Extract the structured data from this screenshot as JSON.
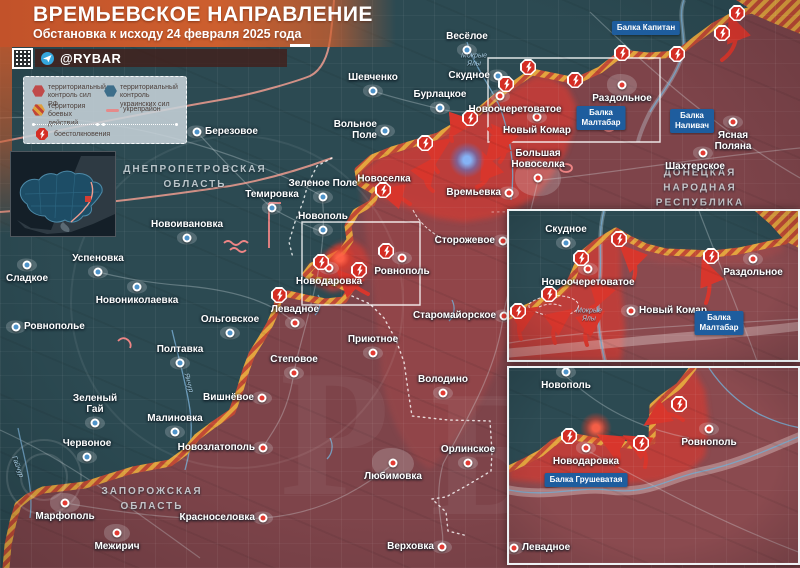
{
  "header": {
    "title": "ВРЕМЬЕВСКОЕ НАПРАВЛЕНИЕ",
    "subtitle": "Обстановка к исходу 24 февраля 2025 года",
    "channel": "@RYBAR"
  },
  "legend": {
    "items": [
      {
        "id": "rf",
        "label": "территориальный контроль сил РФ"
      },
      {
        "id": "ua",
        "label": "территориальный контроль украинских сил"
      },
      {
        "id": "battle",
        "label": "территория боевых действий"
      },
      {
        "id": "fort",
        "label": "укрепрайон"
      },
      {
        "id": "clash",
        "label": "боестолкновения"
      }
    ]
  },
  "colors": {
    "rf_area": "#7e444a",
    "ua_area": "#2c4a52",
    "advance": "#c53c38",
    "front_hatch_orange": "#e3a43e",
    "front_hatch_red": "#c14a35",
    "arrow": "#d8362c",
    "balka_box": "#1e5d9e",
    "banner": "#cd5f2e"
  },
  "map": {
    "size": [
      800,
      568
    ],
    "shapes": [
      {
        "c": "rf",
        "d": "M 800,30 L 775,20 L 752,10 L 736,14 L 714,26 L 695,40 L 677,54 L 648,56 L 622,53 L 600,70 L 576,81 L 552,76 L 532,72 L 512,86 L 496,97 L 478,112 L 460,123 L 438,136 L 412,144 L 392,150 L 372,158 L 358,170 L 360,183 L 376,192 L 372,203 L 356,212 L 348,226 L 350,240 L 342,252 L 326,260 L 312,266 L 306,274 L 316,280 L 336,283 L 350,290 L 344,300 L 326,302 L 306,298 L 288,294 L 279,296 L 276,310 L 270,324 L 262,338 L 252,354 L 246,370 L 240,390 L 232,412 L 213,425 L 197,437 L 185,452 L 170,463 L 133,470 L 110,477 L 85,485 L 60,488 L 43,490 L 28,497 L 18,505 L 13,522 L 8,545 L 6,568 L 800,568 Z"
      },
      {
        "c": "mid",
        "d": "M 360,180 C 420,200 470,215 520,210 C 540,250 520,320 500,360 C 480,410 450,450 430,470 C 400,450 380,400 380,350 C 375,300 365,240 360,180 Z"
      },
      {
        "c": "bright",
        "d": "M 360,172 L 380,156 L 410,146 L 438,138 L 462,125 L 482,113 L 500,98 L 515,88 L 535,76 L 552,78 L 568,88 L 576,105 L 574,128 L 566,152 L 552,176 L 536,196 L 514,210 L 490,218 L 464,222 L 436,218 L 408,208 L 384,198 L 366,188 Z"
      },
      {
        "c": "bright",
        "d": "M 306,270 L 322,256 L 338,244 L 352,240 L 364,248 L 370,262 L 366,276 L 352,287 L 332,292 L 314,284 Z"
      },
      {
        "c": "road",
        "d": "M 590,12 C 650,70 720,132 800,178"
      },
      {
        "c": "road",
        "d": "M 0,118 C 110,112 240,150 322,196"
      },
      {
        "c": "road",
        "d": "M 322,196 C 330,260 302,330 294,372 C 287,420 268,436 263,448"
      },
      {
        "c": "road",
        "d": "M 538,180 C 522,250 507,290 503,318 C 496,372 466,420 443,464 C 432,505 446,530 442,546"
      },
      {
        "c": "road",
        "d": "M 540,180 C 600,175 680,160 800,148"
      },
      {
        "c": "road",
        "d": "M 0,430 C 70,462 122,502 200,558"
      },
      {
        "c": "road",
        "d": "M 197,132 C 232,170 252,190 272,208 C 292,220 308,226 322,232"
      },
      {
        "c": "road",
        "d": "M 65,503 C 140,516 205,522 263,518 C 320,514 360,490 393,464"
      },
      {
        "c": "road",
        "d": "M 373,91 C 400,100 425,105 440,109 C 460,114 480,112 498,108"
      },
      {
        "c": "road",
        "d": "M 98,272 C 130,280 160,284 187,286 C 230,290 270,300 295,323"
      },
      {
        "c": "riverw",
        "d": "M 684,0 C 676,20 690,42 680,62 C 672,82 658,98 650,112 C 644,124 640,133 638,142"
      },
      {
        "c": "river",
        "d": "M 684,0 C 676,20 690,42 680,62 C 672,82 658,98 650,112"
      },
      {
        "c": "river",
        "d": "M 467,42 C 475,70 496,92 503,116 C 512,146 515,172 511,200"
      },
      {
        "c": "river",
        "d": "M 172,330 C 178,356 186,382 190,410 C 193,430 190,452 185,470"
      },
      {
        "c": "river",
        "d": "M 18,428 C 24,458 34,488 30,518"
      },
      {
        "c": "river",
        "d": "M 318,295 C 322,302 320,310 315,315"
      },
      {
        "c": "river",
        "d": "M 452,300 C 456,308 454,316 449,321"
      },
      {
        "c": "river",
        "d": "M 330,438 C 334,446 332,454 327,459"
      },
      {
        "c": "salmon",
        "d": "M 0,142 C 70,128 150,112 220,100 C 260,93 300,80 310,76 C 322,70 328,55 330,40 C 332,26 333,12 334,0"
      },
      {
        "c": "salmon",
        "d": "M 0,212 C 70,207 150,198 230,186 C 270,179 305,168 332,158"
      },
      {
        "c": "dotted",
        "d": "M 332,158 L 317,166 L 308,184 L 303,202 L 295,222 L 289,242 L 293,258"
      },
      {
        "c": "dotted",
        "d": "M 352,296 L 370,304 L 384,318 L 396,340 L 404,362 L 408,390 L 412,416 L 448,420 L 490,421 L 492,452 L 491,471 L 466,486 L 446,497 L 432,499 L 446,512 L 448,531 L 468,536"
      },
      {
        "c": "dotted2",
        "d": "M 492,212 L 710,209"
      },
      {
        "c": "hatchfill",
        "d": "M 736,0 L 800,0 L 800,30 L 752,10 Z"
      },
      {
        "c": "front",
        "d": "M 800,30 L 775,20 L 752,10 L 736,14 L 714,26 L 695,40 L 677,54 L 648,56 L 622,53 L 600,70 L 576,81 L 552,76 L 532,72 L 512,86 L 496,97 L 478,112 L 460,123 L 438,136 L 412,144 L 392,150 L 372,158 L 358,170 L 360,183 L 376,192 L 372,203 L 356,212 L 348,226 L 350,240 L 342,252 L 326,260 L 312,266 L 306,274 L 316,280 L 336,283 L 350,290 L 344,300 L 326,302 L 306,298 L 288,294 L 279,296 L 276,310 L 270,324 L 262,338 L 252,354 L 246,370 L 240,390 L 232,412 L 213,425 L 197,437 L 185,452 L 170,463 L 133,470 L 110,477 L 85,485 L 60,488 L 43,490 L 28,497 L 18,505 L 13,522 L 8,545 L 6,568"
      },
      {
        "c": "fort",
        "d": "M 269,203 L 269,248 M 269,203 L 281,203"
      },
      {
        "c": "fort",
        "d": "M 224,243 q 4,-4 8,0 q 4,4 8,0 q 4,-4 8,0"
      },
      {
        "c": "fort",
        "d": "M 230,250 q 4,-4 8,0 q 4,4 8,0"
      },
      {
        "c": "fort",
        "d": "M 118,341 q 5,-5 10,-1 q 4,4 2,8"
      },
      {
        "c": "fort",
        "d": "M 560,168 a 6,4 0 1 0 12,0 a 6,4 0 1 0 -12,0"
      },
      {
        "c": "fort",
        "d": "M 604,128 a 5,3 0 1 0 10,0 a 5,3 0 1 0 -10,0"
      },
      {
        "c": "trench",
        "d": "M 413,210 C 419,222 428,230 438,236"
      },
      {
        "c": "frame",
        "d": "M 488,58 H 660 V 142 H 488 Z"
      },
      {
        "c": "frame",
        "d": "M 302,222 H 420 V 305 H 302 Z"
      }
    ],
    "arrows": [
      "M 722,60 C 733,52 739,40 734,27",
      "M 438,172 C 430,163 431,152 440,146",
      "M 452,141 C 449,132 454,124 464,123",
      "M 489,129 C 497,135 499,146 493,154",
      "M 477,187 C 487,183 491,174 487,164",
      "M 433,191 C 425,185 423,175 429,167",
      "M 500,162 C 507,153 507,142 500,134",
      "M 410,204 C 402,198 396,195 389,193",
      "M 368,294 C 360,290 352,285 346,279"
    ],
    "clashes": [
      [
        470,
        118
      ],
      [
        425,
        143
      ],
      [
        528,
        67
      ],
      [
        506,
        84
      ],
      [
        575,
        80
      ],
      [
        622,
        53
      ],
      [
        677,
        54
      ],
      [
        722,
        33
      ],
      [
        737,
        13
      ],
      [
        383,
        190
      ],
      [
        386,
        251
      ],
      [
        359,
        270
      ],
      [
        321,
        262
      ],
      [
        279,
        295
      ]
    ],
    "glows": [
      {
        "x": 467,
        "y": 160,
        "c": "blue"
      },
      {
        "x": 340,
        "y": 258,
        "c": "red"
      }
    ],
    "towns": [
      {
        "n": "Шевченко",
        "x": 373,
        "y": 91,
        "s": "ua",
        "lp": "above"
      },
      {
        "n": "Бурлацкое",
        "x": 440,
        "y": 108,
        "s": "ua",
        "lp": "above"
      },
      {
        "n": "Весёлое",
        "x": 467,
        "y": 50,
        "s": "ua",
        "lp": "above"
      },
      {
        "n": "Скудное",
        "x": 498,
        "y": 76,
        "s": "ua",
        "lp": "left"
      },
      {
        "n": "Вольное\nПоле",
        "x": 385,
        "y": 131,
        "s": "ua",
        "lp": "left"
      },
      {
        "n": "Березовое",
        "x": 197,
        "y": 132,
        "s": "ua",
        "lp": "right"
      },
      {
        "n": "Зеленое Поле",
        "x": 323,
        "y": 197,
        "s": "ua",
        "lp": "above"
      },
      {
        "n": "Темировка",
        "x": 272,
        "y": 208,
        "s": "ua",
        "lp": "above"
      },
      {
        "n": "Новополь",
        "x": 323,
        "y": 230,
        "s": "ua",
        "lp": "above"
      },
      {
        "n": "Новоивановка",
        "x": 187,
        "y": 238,
        "s": "ua",
        "lp": "above"
      },
      {
        "n": "Успеновка",
        "x": 98,
        "y": 272,
        "s": "ua",
        "lp": "above"
      },
      {
        "n": "Сладкое",
        "x": 27,
        "y": 265,
        "s": "ua",
        "lp": "below"
      },
      {
        "n": "Новониколаевка",
        "x": 137,
        "y": 287,
        "s": "ua",
        "lp": "below"
      },
      {
        "n": "Ровнополье",
        "x": 16,
        "y": 327,
        "s": "ua",
        "lp": "right"
      },
      {
        "n": "Ольговское",
        "x": 230,
        "y": 333,
        "s": "ua",
        "lp": "above"
      },
      {
        "n": "Полтавка",
        "x": 180,
        "y": 363,
        "s": "ua",
        "lp": "above"
      },
      {
        "n": "Зеленый\nГай",
        "x": 95,
        "y": 423,
        "s": "ua",
        "lp": "above"
      },
      {
        "n": "Малиновка",
        "x": 175,
        "y": 432,
        "s": "ua",
        "lp": "above"
      },
      {
        "n": "Червоное",
        "x": 87,
        "y": 457,
        "s": "ua",
        "lp": "above"
      },
      {
        "n": "Новоселка",
        "x": 384,
        "y": 179,
        "s": "none",
        "lp": "center"
      },
      {
        "n": "Времьевка",
        "x": 509,
        "y": 193,
        "s": "ru",
        "lp": "left"
      },
      {
        "n": "Большая\nНовоселка",
        "x": 538,
        "y": 178,
        "s": "ru",
        "lp": "above",
        "b": [
          46,
          36
        ]
      },
      {
        "n": "Сторожевое",
        "x": 503,
        "y": 241,
        "s": "ru",
        "lp": "left"
      },
      {
        "n": "Ровнополь",
        "x": 402,
        "y": 258,
        "s": "ru",
        "lp": "below"
      },
      {
        "n": "Новодаровка",
        "x": 329,
        "y": 268,
        "s": "ru",
        "lp": "below"
      },
      {
        "n": "Старомайорское",
        "x": 504,
        "y": 316,
        "s": "ru",
        "lp": "left"
      },
      {
        "n": "Левадное",
        "x": 295,
        "y": 323,
        "s": "ru",
        "lp": "above"
      },
      {
        "n": "Степовое",
        "x": 294,
        "y": 373,
        "s": "ru",
        "lp": "above"
      },
      {
        "n": "Приютное",
        "x": 373,
        "y": 353,
        "s": "ru",
        "lp": "above"
      },
      {
        "n": "Володино",
        "x": 443,
        "y": 393,
        "s": "ru",
        "lp": "above"
      },
      {
        "n": "Любимовка",
        "x": 393,
        "y": 463,
        "s": "ru",
        "lp": "below",
        "b": [
          42,
          30
        ]
      },
      {
        "n": "Орлинское",
        "x": 468,
        "y": 463,
        "s": "ru",
        "lp": "above"
      },
      {
        "n": "Верховка",
        "x": 442,
        "y": 547,
        "s": "ru",
        "lp": "left"
      },
      {
        "n": "Вишнёвое",
        "x": 262,
        "y": 398,
        "s": "ru",
        "lp": "left"
      },
      {
        "n": "Новозлатополь",
        "x": 263,
        "y": 448,
        "s": "ru",
        "lp": "left"
      },
      {
        "n": "Красноселовка",
        "x": 263,
        "y": 518,
        "s": "ru",
        "lp": "left"
      },
      {
        "n": "Марфополь",
        "x": 65,
        "y": 503,
        "s": "ru",
        "lp": "below",
        "b": [
          30,
          20
        ]
      },
      {
        "n": "Межирич",
        "x": 117,
        "y": 533,
        "s": "ru",
        "lp": "below",
        "b": [
          26,
          18
        ]
      },
      {
        "n": "Раздольное",
        "x": 622,
        "y": 85,
        "s": "ru",
        "lp": "below",
        "b": [
          30,
          22
        ]
      },
      {
        "n": "Новый Комар",
        "x": 537,
        "y": 117,
        "s": "ru",
        "lp": "below"
      },
      {
        "n": "Новоочеретоватое",
        "x": 500,
        "y": 96,
        "s": "ru",
        "lp": "below",
        "dx": 15
      },
      {
        "n": "Шахтерское",
        "x": 703,
        "y": 153,
        "s": "ru",
        "lp": "below",
        "dx": -8
      },
      {
        "n": "Ясная\nПоляна",
        "x": 733,
        "y": 122,
        "s": "ru",
        "lp": "below"
      }
    ],
    "labels": [
      {
        "t": "ДНЕПРОПЕТРОВСКАЯ\nОБЛАСТЬ",
        "x": 195,
        "y": 177,
        "cls": "region"
      },
      {
        "t": "ЗАПОРОЖСКАЯ\nОБЛАСТЬ",
        "x": 152,
        "y": 499,
        "cls": "region"
      },
      {
        "t": "ДОНЕЦКАЯ\nНАРОДНАЯ\nРЕСПУБЛИКА",
        "x": 700,
        "y": 188,
        "cls": "region"
      },
      {
        "t": "Мокрые\nЯлы",
        "x": 474,
        "y": 60,
        "cls": "rivlab",
        "rot": 0
      },
      {
        "t": "Янчур",
        "x": 188,
        "y": 383,
        "cls": "rivlab",
        "rot": 75
      },
      {
        "t": "Гайчур",
        "x": 17,
        "y": 467,
        "cls": "rivlab",
        "rot": 70
      }
    ],
    "boxes": [
      {
        "t": "Балка Капитан",
        "x": 646,
        "y": 28
      },
      {
        "t": "Балка\nМалтабар",
        "x": 601,
        "y": 118
      },
      {
        "t": "Балка\nНаливач",
        "x": 692,
        "y": 121
      }
    ]
  },
  "inset_top": {
    "size": [
      292,
      150
    ],
    "shapes": [
      {
        "c": "teal",
        "d": "M 0,0 L 246,0 L 262,14 L 276,30 L 230,40 L 204,43 L 157,41 L 137,36 L 120,28 L 107,20 L 87,32 L 75,42 L 69,53 L 64,65 L 59,75 L 50,82 L 40,87 L 29,92 L 17,97 L 0,105 Z"
      },
      {
        "c": "mid",
        "d": "M 110,22 L 150,38 L 200,42 L 240,38 L 270,30 L 276,40 L 240,52 L 200,55 L 150,52 L 115,42 Z"
      },
      {
        "c": "bright",
        "d": "M 107,20 L 87,32 L 75,42 L 69,53 L 64,65 L 59,75 L 50,82 L 40,87 L 29,92 L 17,97 L 0,105 L 0,150 L 112,150 L 116,118 L 112,75 L 112,40 Z"
      },
      {
        "c": "road",
        "d": "M 0,132 C 60,122 140,116 292,108"
      },
      {
        "c": "road",
        "d": "M 190,0 C 205,40 228,95 248,150"
      },
      {
        "c": "wet",
        "d": "M 0,142 C 70,136 140,128 200,124 C 240,121 268,118 292,115"
      },
      {
        "c": "riverw",
        "d": "M 95,0 C 88,25 94,50 90,75 C 87,100 90,125 96,150"
      },
      {
        "c": "river",
        "d": "M 95,0 C 88,25 94,50 90,75 C 87,100 90,125 96,150"
      },
      {
        "c": "hatchfill",
        "d": "M 246,0 L 292,0 L 292,38 L 276,30 L 262,14 Z"
      },
      {
        "c": "front",
        "d": "M 276,30 L 230,40 L 204,43 L 157,41 L 137,36 L 120,28 L 107,20 L 87,32 L 75,42 L 69,53 L 64,65 L 59,75 L 50,82 L 40,87 L 29,92 L 17,97 L 0,105"
      },
      {
        "c": "trench",
        "d": "M 20,93 C 30,84 52,82 64,88 C 74,93 70,102 55,104 C 38,107 24,101 20,96 Z"
      },
      {
        "c": "trench",
        "d": "M 30,96 C 38,92 48,92 54,96"
      }
    ],
    "arrows": [
      "M 124,70 C 128,60 127,50 120,43",
      "M 197,92 C 201,81 202,70 198,60",
      "M 82,97 C 91,93 95,85 88,77",
      "M 12,128 C 8,117 10,108 18,103",
      "M 46,132 C 42,121 45,112 53,106",
      "M 78,134 C 74,123 77,114 85,108"
    ],
    "clashes": [
      [
        110,
        28
      ],
      [
        72,
        47
      ],
      [
        40,
        83
      ],
      [
        9,
        100
      ],
      [
        202,
        45
      ]
    ],
    "glows": [],
    "towns": [
      {
        "n": "Скудное",
        "x": 57,
        "y": 32,
        "s": "ua",
        "lp": "above"
      },
      {
        "n": "Новоочеретоватое",
        "x": 79,
        "y": 58,
        "s": "ru",
        "lp": "below"
      },
      {
        "n": "Новый Комар",
        "x": 122,
        "y": 100,
        "s": "ru",
        "lp": "right"
      },
      {
        "n": "Раздольное",
        "x": 244,
        "y": 48,
        "s": "ru",
        "lp": "below"
      }
    ],
    "labels": [
      {
        "t": "Мокрые\nЯлы",
        "x": 80,
        "y": 104,
        "cls": "rivlab",
        "rot": 0
      }
    ],
    "boxes": [
      {
        "t": "Балка\nМалтабар",
        "x": 210,
        "y": 112
      }
    ]
  },
  "inset_bottom": {
    "size": [
      292,
      198
    ],
    "shapes": [
      {
        "c": "teal",
        "d": "M 0,0 L 184,0 L 170,18 L 152,31 L 144,38 L 143,73 L 132,78 L 97,75 L 77,71 L 60,68 L 44,75 L 32,85 L 17,93 L 0,101 Z"
      },
      {
        "c": "bright",
        "d": "M 184,0 L 170,18 L 152,31 L 144,38 L 143,73 L 132,78 L 97,75 L 77,71 L 60,68 L 44,75 L 32,85 L 17,93 L 0,101 L 0,112 L 50,116 L 100,117 L 150,113 L 180,104 L 196,88 L 200,55 L 196,22 Z"
      },
      {
        "c": "road",
        "d": "M 77,82 C 130,110 200,150 292,185"
      },
      {
        "c": "road",
        "d": "M 57,8 C 90,40 130,60 180,70"
      },
      {
        "c": "wet",
        "d": "M 0,122 C 40,130 70,118 100,122 C 140,127 160,110 190,104 C 230,96 262,80 292,68"
      },
      {
        "c": "river",
        "d": "M 0,122 C 40,130 70,118 100,122 C 140,127 160,110 190,104 C 230,96 262,80 292,68"
      },
      {
        "c": "river",
        "d": "M 200,0 C 212,18 228,34 250,46 C 266,54 280,58 292,60"
      },
      {
        "c": "front",
        "d": "M 184,0 L 170,18 L 152,31 L 144,38 L 143,73 L 132,78 L 97,75 L 77,71 L 60,68 L 44,75 L 32,85 L 17,93 L 0,101"
      }
    ],
    "arrows": [
      "M 174,52 C 164,45 155,44 146,50",
      "M 108,98 C 112,87 109,78 100,73",
      "M 136,99 C 139,88 135,79 126,74"
    ],
    "clashes": [
      [
        170,
        36
      ],
      [
        60,
        68
      ],
      [
        132,
        75
      ]
    ],
    "glows": [
      {
        "x": 87,
        "y": 60,
        "c": "red"
      }
    ],
    "towns": [
      {
        "n": "Новополь",
        "x": 57,
        "y": 4,
        "s": "ua",
        "lp": "below"
      },
      {
        "n": "Ровнополь",
        "x": 200,
        "y": 61,
        "s": "ru",
        "lp": "below"
      },
      {
        "n": "Новодаровка",
        "x": 77,
        "y": 80,
        "s": "ru",
        "lp": "below"
      },
      {
        "n": "Левадное",
        "x": 5,
        "y": 180,
        "s": "ru",
        "lp": "right"
      }
    ],
    "labels": [],
    "boxes": [
      {
        "t": "Балка Грушеватая",
        "x": 77,
        "y": 112
      }
    ]
  }
}
